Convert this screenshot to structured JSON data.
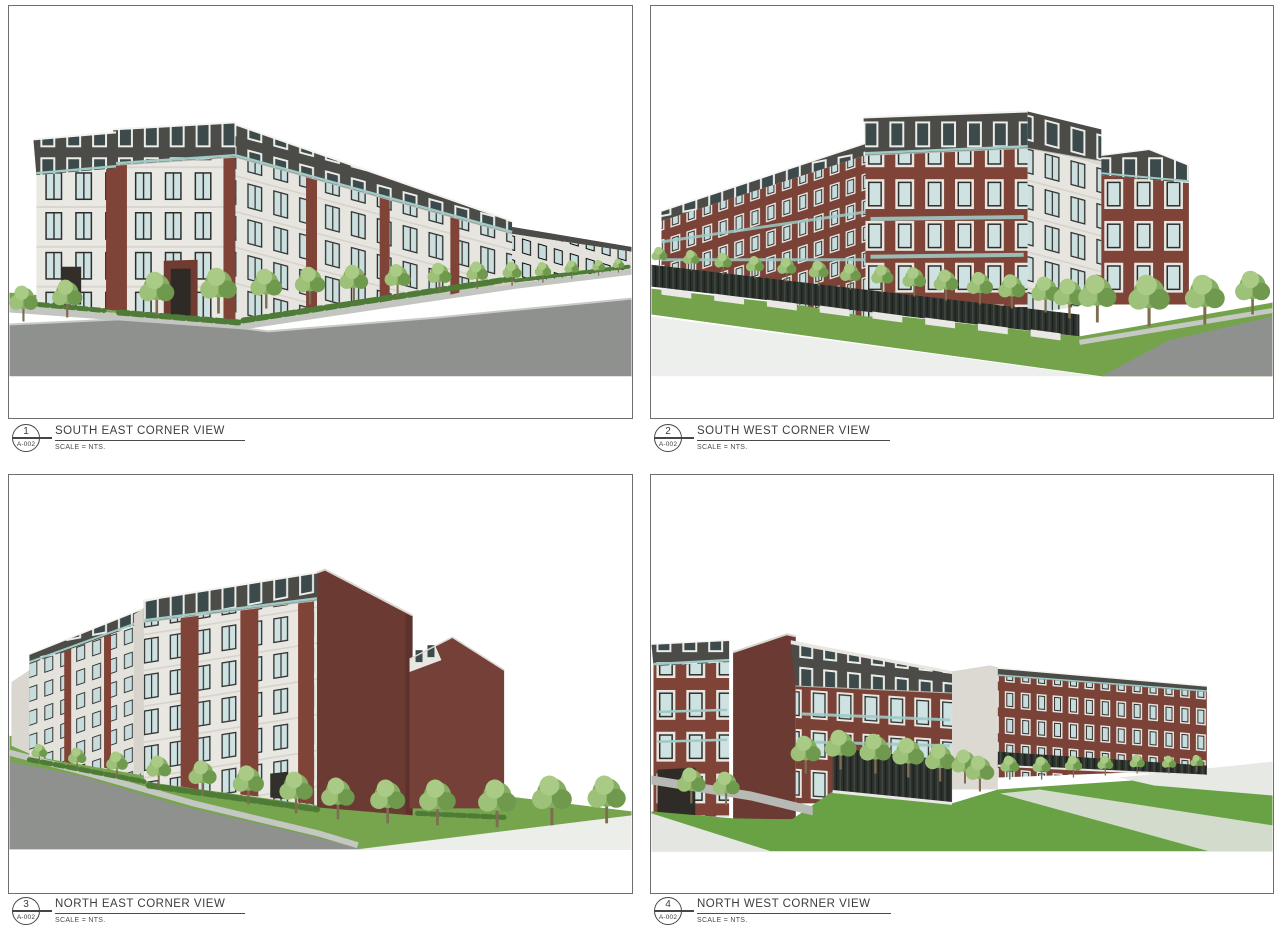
{
  "panels": [
    {
      "number": "1",
      "detail_ref": "A-002",
      "title": "SOUTH EAST CORNER VIEW",
      "scale": "SCALE = NTS."
    },
    {
      "number": "2",
      "detail_ref": "A-002",
      "title": "SOUTH WEST CORNER VIEW",
      "scale": "SCALE = NTS."
    },
    {
      "number": "3",
      "detail_ref": "A-002",
      "title": "NORTH EAST CORNER VIEW",
      "scale": "SCALE = NTS."
    },
    {
      "number": "4",
      "detail_ref": "A-002",
      "title": "NORTH WEST CORNER VIEW",
      "scale": "SCALE = NTS."
    }
  ],
  "palette": {
    "stone": "#eae8e2",
    "brick": "#7f4437",
    "brick_dark": "#6b3a32",
    "roof": "#4b4b48",
    "glass": "#cfe2e2",
    "balustrade": "#9fcac5",
    "grass": "#76a54e",
    "lawn": "#68a244",
    "road": "#8f918f",
    "sidewalk": "#c5c7c3",
    "pavement": "#edefec",
    "fence": "#2c312c",
    "tree_foliage": "#8cb468",
    "drawing_line": "#474747"
  }
}
